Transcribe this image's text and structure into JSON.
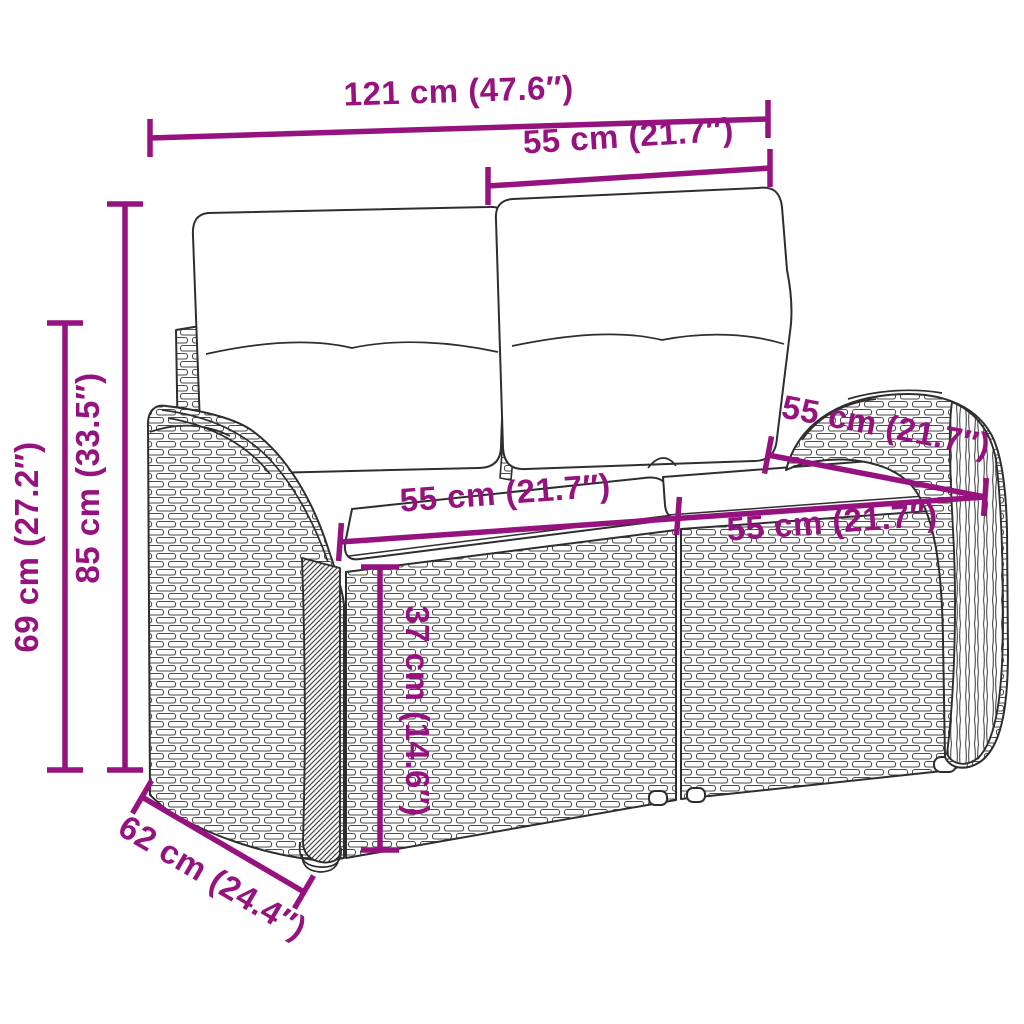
{
  "diagram": {
    "kind": "product-dimension-diagram",
    "subject": "rattan-garden-bench-with-cushions",
    "accent_color": "#96137F",
    "outline_color": "#2E2E2E",
    "background": "#FFFFFF",
    "dimensions": {
      "overall_width": {
        "label": "121 cm (47.6″)",
        "cm": 121,
        "inch": 47.6
      },
      "backrest_width": {
        "label": "55 cm (21.7″)",
        "cm": 55,
        "inch": 21.7
      },
      "total_height": {
        "label": "85 cm (33.5″)",
        "cm": 85,
        "inch": 33.5
      },
      "armrest_height": {
        "label": "69 cm (27.2″)",
        "cm": 69,
        "inch": 27.2
      },
      "total_depth": {
        "label": "62 cm (24.4″)",
        "cm": 62,
        "inch": 24.4
      },
      "seat_width_left": {
        "label": "55 cm (21.7″)",
        "cm": 55,
        "inch": 21.7
      },
      "seat_height": {
        "label": "37 cm (14.6″)",
        "cm": 37,
        "inch": 14.6
      },
      "seat_depth": {
        "label": "55 cm (21.7″)",
        "cm": 55,
        "inch": 21.7
      },
      "seat_width_right": {
        "label": "55 cm (21.7″)",
        "cm": 55,
        "inch": 21.7
      }
    }
  }
}
